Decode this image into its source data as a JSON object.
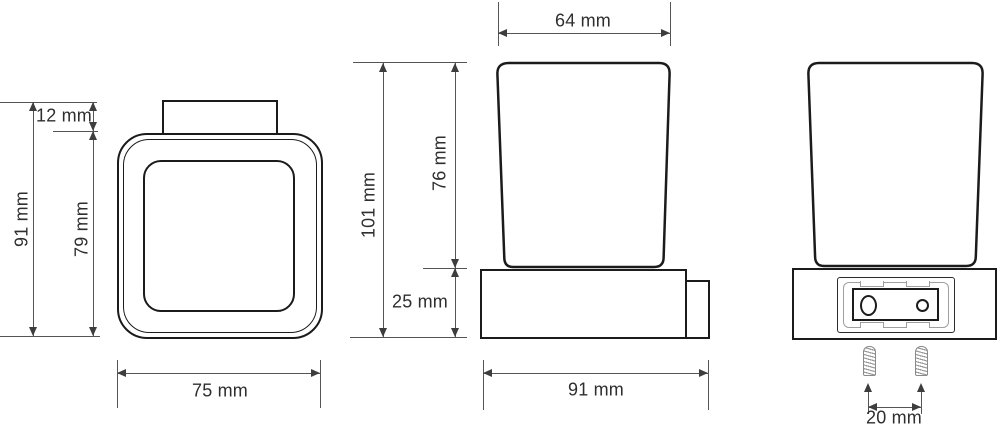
{
  "drawing": {
    "type": "technical-dimension-drawing",
    "subject": "wall-mounted square glass tumbler holder, three orthographic views",
    "colors": {
      "background": "#ffffff",
      "object_line": "#1b1b1b",
      "dimension_line": "#555557",
      "label_text": "#2e2e2e"
    }
  },
  "labels": {
    "front_bracket_height": "12 mm",
    "front_overall_height": "91 mm",
    "front_body_height": "79 mm",
    "front_width": "75 mm",
    "side_cup_top_width": "64 mm",
    "side_total_height": "101 mm",
    "side_cup_height": "76 mm",
    "side_holder_height": "25 mm",
    "side_depth": "91 mm",
    "back_screw_spacing": "20 mm"
  }
}
